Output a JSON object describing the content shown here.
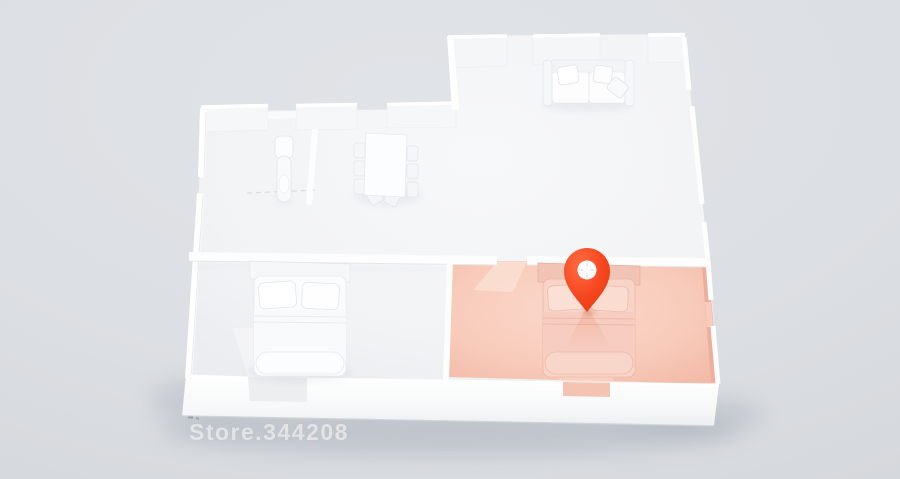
{
  "scene": {
    "type": "3d-floorplan-render",
    "watermark": {
      "text": "Store.344208"
    }
  },
  "icons": {
    "location_pin": "location-pin-icon (teardrop map marker with circular white cutout and faint crosshair)"
  },
  "colors": {
    "background": "#dcdfe3",
    "floor": "#f2f3f5",
    "wall": "#ffffff",
    "highlight_room_fill": "#f5c3b2",
    "highlight_room_light": "#fbdacd",
    "highlight_wall_inner": "#eeae9c",
    "pin_accent": "#f5431f",
    "pin_hole": "#ffffff",
    "building_shadow": "#9aa3ae"
  }
}
